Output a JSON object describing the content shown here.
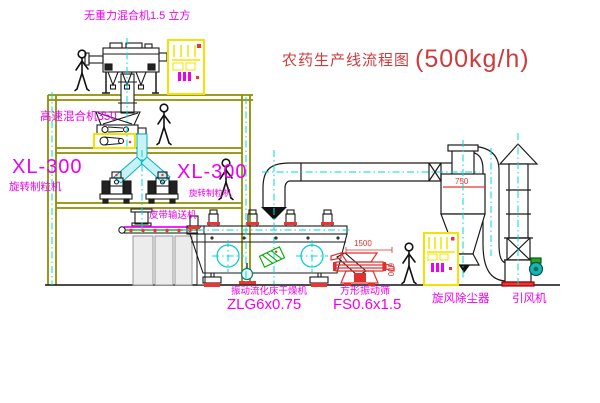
{
  "title": {
    "main": "农药生产线流程图",
    "capacity": "(500kg/h)"
  },
  "labels": {
    "gravity_mixer": "无重力混合机1.5 立方",
    "high_speed_mixer": "高速混合机350",
    "granulator_left_model": "XL-300",
    "granulator_left_name": "旋转制粒机",
    "granulator_right_model": "XL-300",
    "granulator_right_name": "旋转制粒机",
    "belt_conveyor": "皮带输送机",
    "dryer_name": "振动流化床干燥机",
    "dryer_model": "ZLG6x0.75",
    "screen_name": "方形振动筛",
    "screen_model": "FS0.6x1.5",
    "cyclone": "旋风除尘器",
    "fan": "引风机"
  },
  "dimensions": {
    "screen_length": "1500",
    "screen_width": "600",
    "cyclone_width": "750"
  },
  "colors": {
    "label_magenta": "#ee00ee",
    "title_red": "#cf3b3b",
    "dimension_red": "#e03030",
    "structure_olive": "#8f8f00",
    "centerline_cyan": "#00d8d8",
    "cabinet_yellow": "#f2e400",
    "accent_red": "#ee3333",
    "machine_line": "#1a1a1a",
    "screen_red": "#e03030",
    "belt_green": "#00a000",
    "chute_cyan_fill": "#c9f2f5",
    "fan_teal": "#19b5a8"
  }
}
